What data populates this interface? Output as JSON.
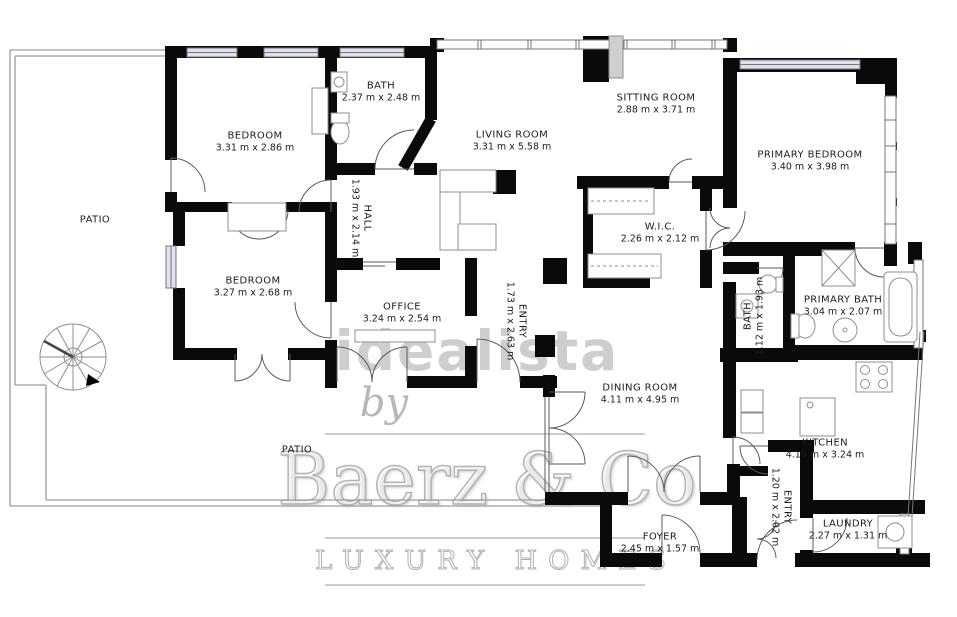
{
  "colors": {
    "wall": "#0a0a0a",
    "label": "#1c1c1c",
    "window_fill": "#dfe1ef",
    "line": "#9c9c9c",
    "watermark": "#c2c2c2",
    "watermark_dark": "#ababab"
  },
  "rooms": [
    {
      "label": "PATIO",
      "dims": ""
    },
    {
      "label": "BEDROOM",
      "dims": "3.31 m x 2.86 m"
    },
    {
      "label": "BATH",
      "dims": "2.37 m x 2.48 m"
    },
    {
      "label": "LIVING ROOM",
      "dims": "3.31 m x 5.58 m"
    },
    {
      "label": "SITTING ROOM",
      "dims": "2.88 m x 3.71 m"
    },
    {
      "label": "PRIMARY BEDROOM",
      "dims": "3.40 m x 3.98 m"
    },
    {
      "label": "HALL",
      "dims": "1.93 m x 2.14 m"
    },
    {
      "label": "W.I.C.",
      "dims": "2.26 m x 2.12 m"
    },
    {
      "label": "BEDROOM",
      "dims": "3.27 m x 2.68 m"
    },
    {
      "label": "OFFICE",
      "dims": "3.24 m x 2.54 m"
    },
    {
      "label": "ENTRY",
      "dims": "1.73 m x 2.63 m"
    },
    {
      "label": "BATH",
      "dims": "1.12 m x 1.93 m"
    },
    {
      "label": "PRIMARY BATH",
      "dims": "3.04 m x 2.07 m"
    },
    {
      "label": "DINING ROOM",
      "dims": "4.11 m x 4.95 m"
    },
    {
      "label": "KITCHEN",
      "dims": "4.19 m x 3.24 m"
    },
    {
      "label": "PATIO",
      "dims": ""
    },
    {
      "label": "FOYER",
      "dims": "2.45 m x 1.57 m"
    },
    {
      "label": "ENTRY",
      "dims": "1.20 m x 2.02 m"
    },
    {
      "label": "LAUNDRY",
      "dims": "2.27 m x 1.31 m"
    }
  ],
  "watermark": {
    "publisher": "idealista",
    "connector": "by",
    "brand": "Baerz & Co",
    "tagline": "LUXURY HOMES"
  }
}
